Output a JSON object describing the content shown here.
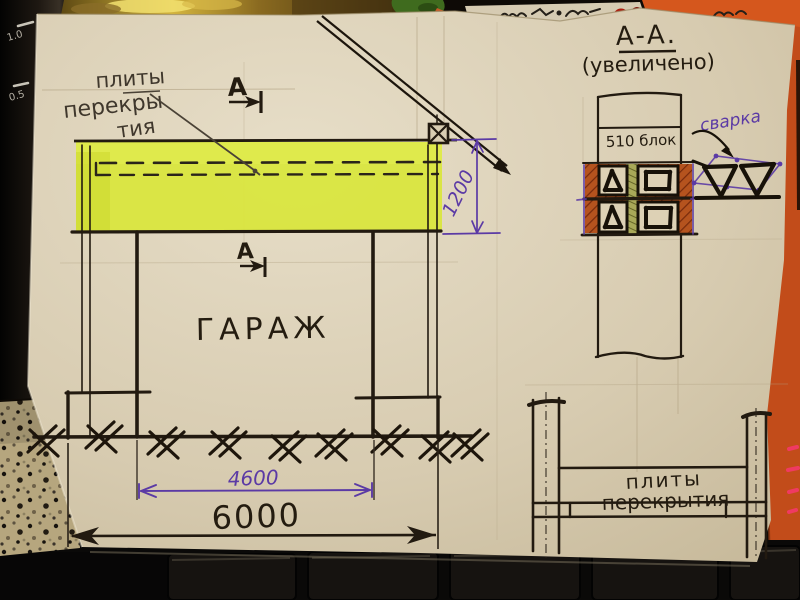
{
  "elevation": {
    "slab_callout": {
      "line1": "плиты",
      "line2": "перекры",
      "line3": "тия"
    },
    "section_mark": "А",
    "room_label": "ГАРАЖ",
    "dim_slab_height": "1200",
    "dim_opening": "4600",
    "dim_overall": "6000"
  },
  "section_detail": {
    "title": "А-А.",
    "subtitle": "(увеличено)",
    "block_label": "510 блок",
    "weld_label": "сварка"
  },
  "slab_detail": {
    "line1": "плиты",
    "line2": "перекрытия"
  },
  "kettle": {
    "mark_upper": "1.0",
    "mark_lower": "0.5"
  },
  "colors": {
    "paper": "#d9cdb2",
    "ink": "#221a10",
    "accent_purple": "#5b3aa5",
    "highlight_yellow": "#d9e63b",
    "block_hatch_orange": "#b5531e",
    "background_orange": "#c64e1a"
  }
}
